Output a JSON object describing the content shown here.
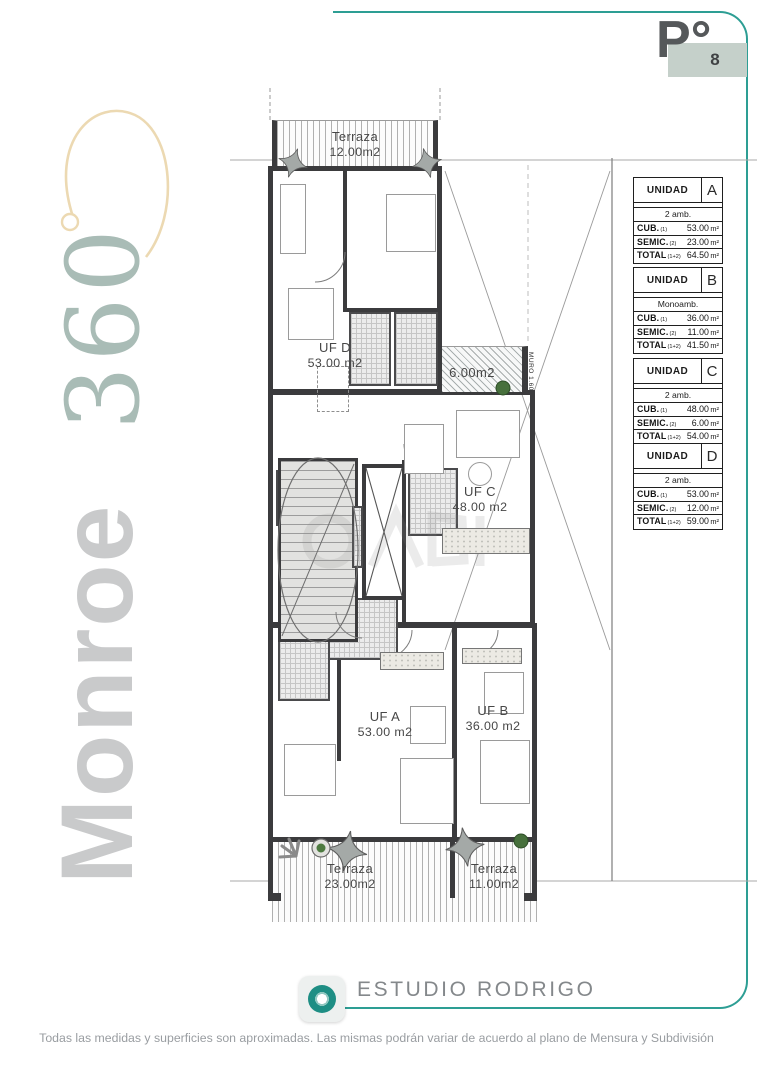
{
  "badge": {
    "floor": "P°",
    "number": "8"
  },
  "brand": {
    "word": "Monroe",
    "number": "360"
  },
  "plan": {
    "terraza_top": {
      "label": "Terraza",
      "area": "12.00m2"
    },
    "balcony_area": "6.00m2",
    "muro": "MURO 1.60",
    "units": {
      "d": {
        "id": "UF D",
        "area": "53.00 m2"
      },
      "c": {
        "id": "UF C",
        "area": "48.00 m2"
      },
      "a": {
        "id": "UF A",
        "area": "53.00 m2"
      },
      "b": {
        "id": "UF B",
        "area": "36.00 m2"
      }
    },
    "terraza_bl": {
      "label": "Terraza",
      "area": "23.00m2"
    },
    "terraza_br": {
      "label": "Terraza",
      "area": "11.00m2"
    }
  },
  "tables": {
    "title": "UNIDAD",
    "unit_suffix": "m²",
    "items": [
      {
        "letter": "A",
        "type": "2 amb.",
        "rows": [
          {
            "label": "CUB.",
            "sub": "(1)",
            "value": "53.00"
          },
          {
            "label": "SEMIC.",
            "sub": "(2)",
            "value": "23.00"
          },
          {
            "label": "TOTAL",
            "sub": "(1+2)",
            "value": "64.50"
          }
        ]
      },
      {
        "letter": "B",
        "type": "Monoamb.",
        "rows": [
          {
            "label": "CUB.",
            "sub": "(1)",
            "value": "36.00"
          },
          {
            "label": "SEMIC.",
            "sub": "(2)",
            "value": "11.00"
          },
          {
            "label": "TOTAL",
            "sub": "(1+2)",
            "value": "41.50"
          }
        ]
      },
      {
        "letter": "C",
        "type": "2 amb.",
        "rows": [
          {
            "label": "CUB.",
            "sub": "(1)",
            "value": "48.00"
          },
          {
            "label": "SEMIC.",
            "sub": "(2)",
            "value": "6.00"
          },
          {
            "label": "TOTAL",
            "sub": "(1+2)",
            "value": "54.00"
          }
        ]
      },
      {
        "letter": "D",
        "type": "2 amb.",
        "rows": [
          {
            "label": "CUB.",
            "sub": "(1)",
            "value": "53.00"
          },
          {
            "label": "SEMIC.",
            "sub": "(2)",
            "value": "12.00"
          },
          {
            "label": "TOTAL",
            "sub": "(1+2)",
            "value": "59.00"
          }
        ]
      }
    ]
  },
  "studio": {
    "name": "ESTUDIO RODRIGO"
  },
  "disclaimer": "Todas las medidas y superficies son aproximadas. Las mismas podrán variar de acuerdo al plano de Mensura y Subdivisión",
  "colors": {
    "teal": "#2d9e94",
    "badge_fill": "#c5d0ca",
    "brand_gray": "#c9cacb",
    "brand_sage": "#a9bcb6",
    "swirl": "#ecd9b2"
  }
}
